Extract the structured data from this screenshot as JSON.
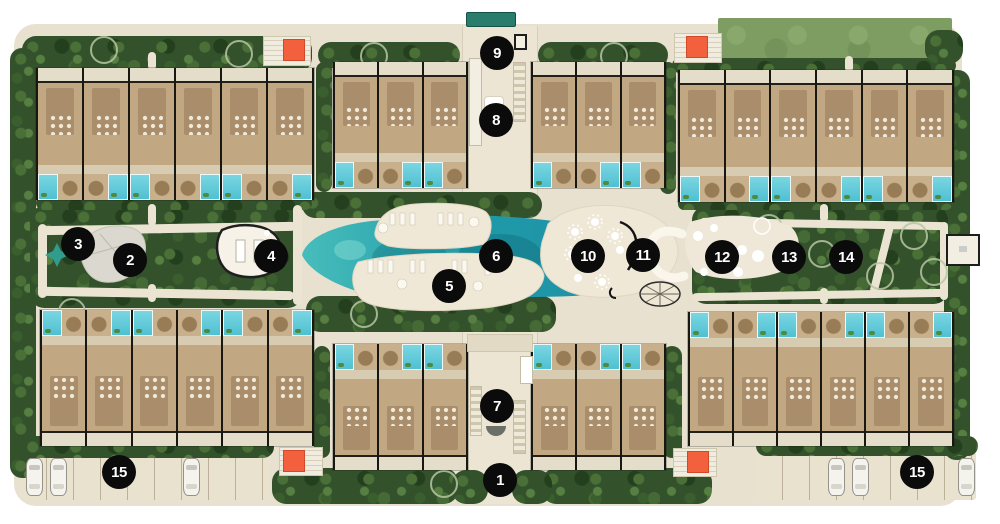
{
  "site": {
    "plan_name": "resort-master-plan",
    "colors": {
      "ground": "#e8e1d0",
      "trees": "#33522c",
      "water": "#2ba4b4",
      "pool": "#5fc9d9",
      "building": "#cdb493",
      "building_core": "#aa8e6c",
      "lawn": "#7d9d62",
      "orange_accent": "#f2603d",
      "sand_deck": "#efe8d7",
      "canopy": "#2a7d6d",
      "marker_bg": "#0b0b0b",
      "marker_text": "#ffffff"
    },
    "markers": [
      {
        "label": "1",
        "x": 500,
        "y": 480
      },
      {
        "label": "2",
        "x": 130,
        "y": 260
      },
      {
        "label": "3",
        "x": 78,
        "y": 244
      },
      {
        "label": "4",
        "x": 271,
        "y": 256
      },
      {
        "label": "5",
        "x": 449,
        "y": 286
      },
      {
        "label": "6",
        "x": 496,
        "y": 256
      },
      {
        "label": "7",
        "x": 497,
        "y": 406
      },
      {
        "label": "8",
        "x": 496,
        "y": 120
      },
      {
        "label": "9",
        "x": 497,
        "y": 53
      },
      {
        "label": "10",
        "x": 588,
        "y": 256
      },
      {
        "label": "11",
        "x": 643,
        "y": 255
      },
      {
        "label": "12",
        "x": 722,
        "y": 257
      },
      {
        "label": "13",
        "x": 789,
        "y": 257
      },
      {
        "label": "14",
        "x": 846,
        "y": 257
      },
      {
        "label": "15",
        "x": 119,
        "y": 472
      },
      {
        "label": "15",
        "x": 917,
        "y": 472
      }
    ],
    "clusters": [
      {
        "x": 36,
        "y": 68,
        "w": 276,
        "h": 132,
        "units": 6,
        "pool": "bottom"
      },
      {
        "x": 333,
        "y": 62,
        "w": 133,
        "h": 126,
        "units": 3,
        "pool": "bottom"
      },
      {
        "x": 531,
        "y": 62,
        "w": 133,
        "h": 126,
        "units": 3,
        "pool": "bottom"
      },
      {
        "x": 678,
        "y": 70,
        "w": 274,
        "h": 132,
        "units": 6,
        "pool": "bottom"
      },
      {
        "x": 40,
        "y": 310,
        "w": 272,
        "h": 136,
        "units": 6,
        "pool": "top"
      },
      {
        "x": 333,
        "y": 344,
        "w": 133,
        "h": 126,
        "units": 3,
        "pool": "top"
      },
      {
        "x": 531,
        "y": 344,
        "w": 133,
        "h": 126,
        "units": 3,
        "pool": "top"
      },
      {
        "x": 688,
        "y": 312,
        "w": 264,
        "h": 134,
        "units": 6,
        "pool": "top"
      }
    ],
    "parking": {
      "strips": [
        {
          "x": 20,
          "y": 452,
          "w": 250,
          "h": 48
        },
        {
          "x": 756,
          "y": 452,
          "w": 220,
          "h": 48
        }
      ],
      "cars": [
        {
          "x": 26,
          "y": 458
        },
        {
          "x": 50,
          "y": 458
        },
        {
          "x": 183,
          "y": 458
        },
        {
          "x": 828,
          "y": 458
        },
        {
          "x": 852,
          "y": 458
        },
        {
          "x": 958,
          "y": 458
        }
      ]
    },
    "orange_pads": [
      {
        "px": 263,
        "py": 36,
        "pw": 46,
        "ph": 28,
        "x": 283,
        "y": 39
      },
      {
        "px": 674,
        "py": 33,
        "pw": 46,
        "ph": 28,
        "x": 686,
        "y": 36
      },
      {
        "px": 279,
        "py": 447,
        "pw": 42,
        "ph": 27,
        "x": 283,
        "y": 450
      },
      {
        "px": 673,
        "py": 448,
        "pw": 42,
        "ph": 27,
        "x": 687,
        "y": 451
      }
    ],
    "lawn": {
      "x": 718,
      "y": 18,
      "w": 234,
      "h": 44
    },
    "canopy": {
      "x": 466,
      "y": 12,
      "w": 48,
      "h": 13
    }
  }
}
